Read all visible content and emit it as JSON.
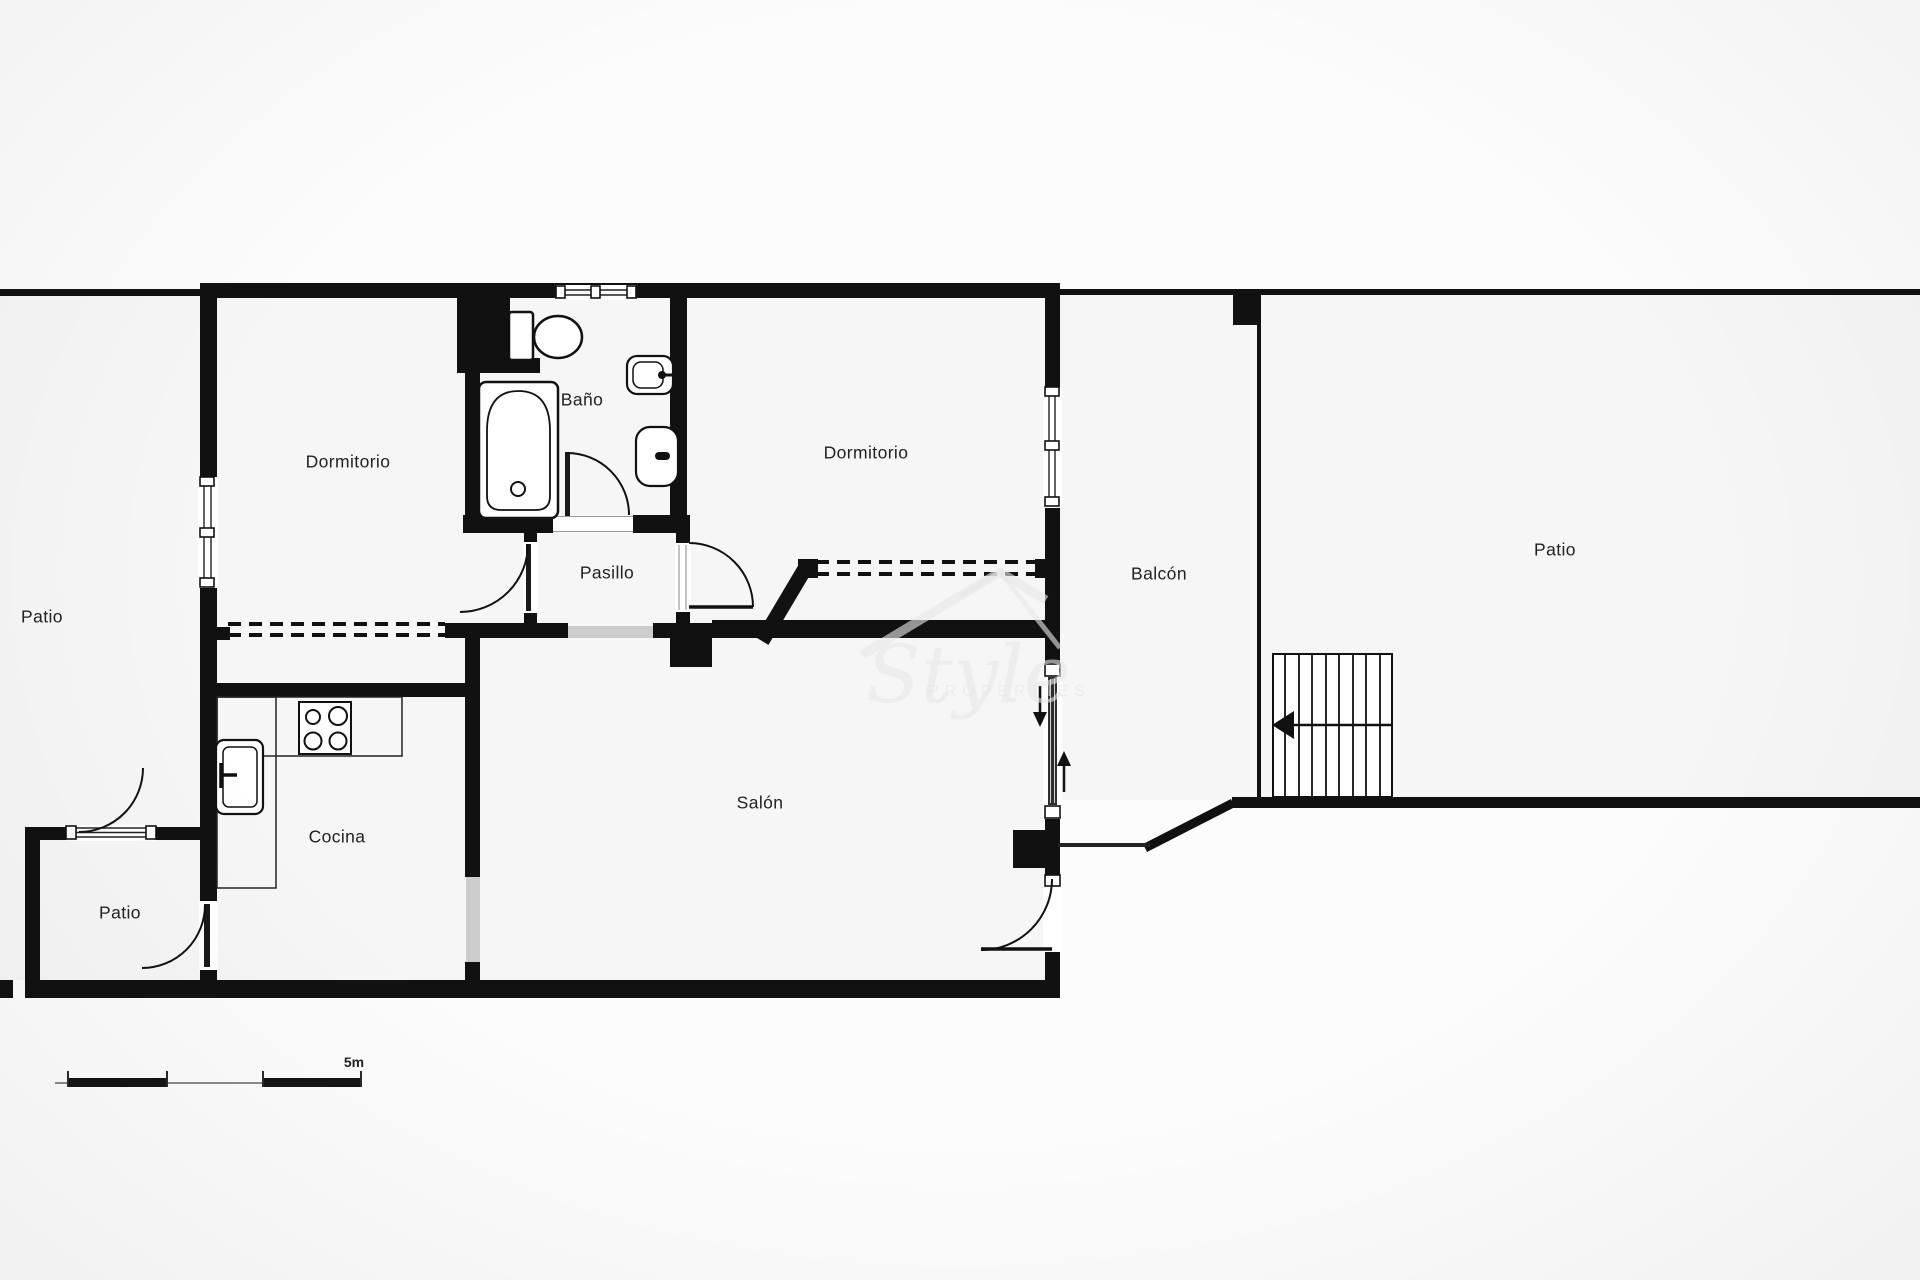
{
  "plan": {
    "rooms": {
      "patio_left": {
        "label": "Patio"
      },
      "dormitorio_1": {
        "label": "Dormitorio"
      },
      "bano": {
        "label": "Baño"
      },
      "dormitorio_2": {
        "label": "Dormitorio"
      },
      "pasillo": {
        "label": "Pasillo"
      },
      "cocina": {
        "label": "Cocina"
      },
      "salon": {
        "label": "Salón"
      },
      "balcon": {
        "label": "Balcón"
      },
      "patio_small": {
        "label": "Patio"
      },
      "patio_right": {
        "label": "Patio"
      }
    },
    "scale_bar": {
      "label": "5m"
    },
    "watermark": {
      "line1": "Style",
      "line2": "PROPERTIES"
    },
    "fixtures": [
      "toilet",
      "bathtub",
      "washbasin",
      "bidet",
      "stove",
      "kitchen-sink",
      "stairs",
      "wardrobe-dashed",
      "entry-arrows"
    ],
    "colors": {
      "wall": "#111111",
      "floor": "#f6f6f6",
      "page": "#fcfcfc",
      "threshold": "#cccccc",
      "label": "#222222",
      "watermark": "rgba(230,230,230,0.62)"
    }
  }
}
